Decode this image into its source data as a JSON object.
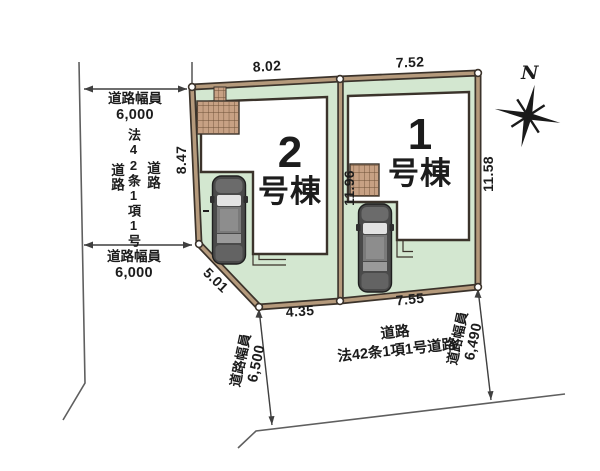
{
  "compass": {
    "north_label": "N"
  },
  "lots": [
    {
      "key": "lot2",
      "number": "2",
      "suffix": "号棟"
    },
    {
      "key": "lot1",
      "number": "1",
      "suffix": "号棟"
    }
  ],
  "dimensions": {
    "lot2_top": "8.02",
    "lot1_top": "7.52",
    "lot2_left": "8.47",
    "boundary_center": "11.96",
    "lot1_right": "11.58",
    "lot2_diagonal": "5.01",
    "bottom_left": "4.35",
    "bottom_right": "7.55"
  },
  "roads": {
    "left": {
      "width_top_label": "道路幅員",
      "width_top_value": "6,000",
      "width_bottom_label": "道路幅員",
      "width_bottom_value": "6,000",
      "name_columns": [
        "道路",
        "法42条1項1号",
        "道路"
      ]
    },
    "bottom": {
      "name_line1": "道路",
      "name_line2": "法42条1項1号道路",
      "width_left_label": "道路幅員",
      "width_left_value": "6,500",
      "width_right_label": "道路幅員",
      "width_right_value": "6,490"
    }
  },
  "colors": {
    "lot_fill": "#d3e7d0",
    "boundary_band": "#b59a7c",
    "line_dark": "#3b332b",
    "deck_fill": "#c7a184",
    "text": "#1c1c1c"
  }
}
